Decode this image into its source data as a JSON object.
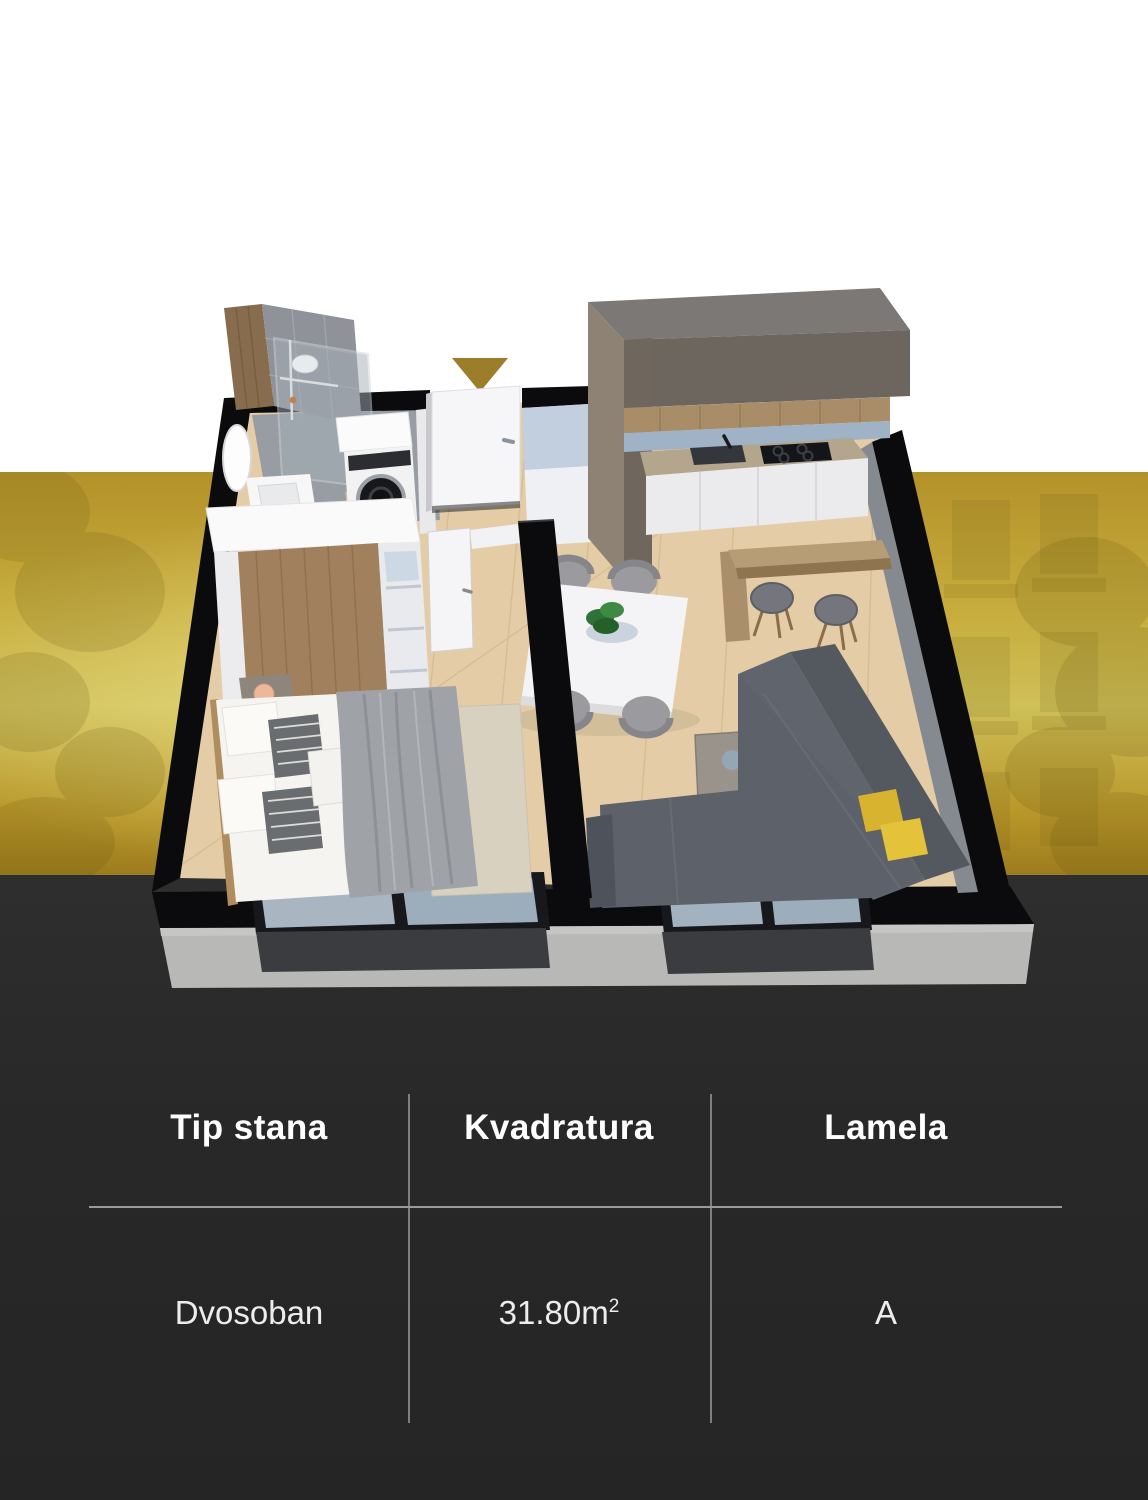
{
  "page": {
    "background_top_color": "#ffffff",
    "background_band_color": "#c3a637",
    "background_bottom_color": "#282828"
  },
  "floor_plan": {
    "description": "3D isometric render of a two-room apartment",
    "entrance_marker_color": "#9b7d2a",
    "accent_pillow_color": "#d9b83a"
  },
  "table": {
    "columns": [
      "Tip stana",
      "Kvadratura",
      "Lamela"
    ],
    "row": {
      "tip_stana": "Dvosoban",
      "kvadratura_value": "31.80m",
      "kvadratura_sup": "2",
      "lamela": "A"
    },
    "header_color": "#ffffff",
    "value_color": "#ededed",
    "divider_color": "#8f8f8f"
  }
}
